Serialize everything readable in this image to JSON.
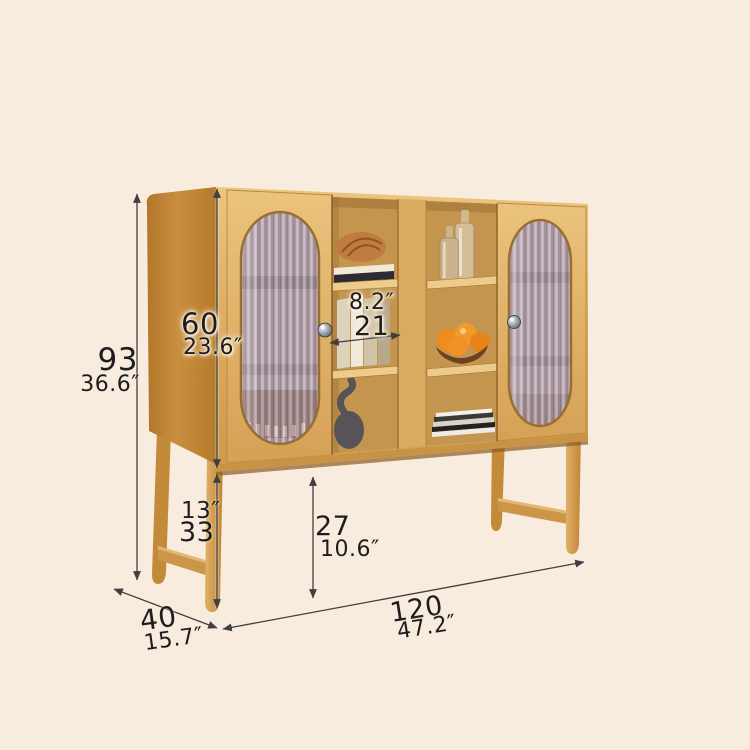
{
  "scene": {
    "background": "#f8ecdf"
  },
  "dimensions": {
    "overall_height": {
      "cm": "93",
      "inch": "36.6″"
    },
    "cabinet_body_height": {
      "cm": "60",
      "inch": "23.6″"
    },
    "shelf_inner_width": {
      "cm": "21",
      "inch": "8.2″"
    },
    "leg_height": {
      "cm": "33",
      "inch": "13″"
    },
    "under_cabinet_clearance": {
      "cm": "27",
      "inch": "10.6″"
    },
    "depth": {
      "cm": "40",
      "inch": "15.7″"
    },
    "overall_width": {
      "cm": "120",
      "inch": "47.2″"
    }
  },
  "colors": {
    "background": "#f8ecdf",
    "wood_front": "#ddab60",
    "wood_side": "#c0802f",
    "wood_interior": "#c3954e",
    "fluted_glass": "#b2a1a9",
    "dimension_lines": "#3f3f3f",
    "label_text": "#1d1d1d",
    "oranges": "#ee8c1e"
  }
}
